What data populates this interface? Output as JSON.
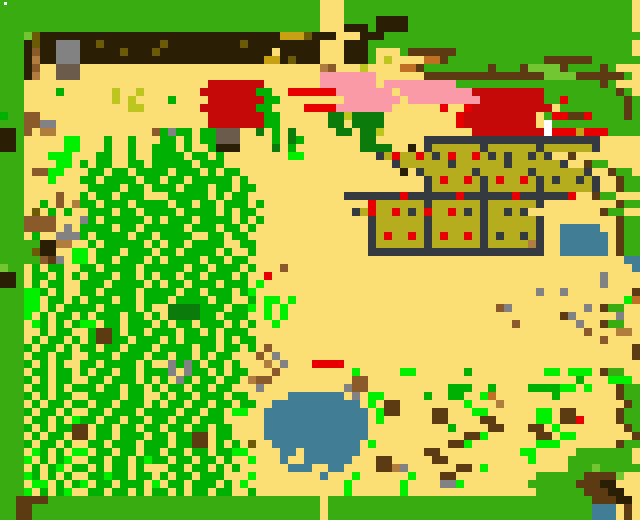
{
  "map": {
    "label": "Top-down pixel-art game world map with sand clearing, western forest, farm plots, buildings and ponds",
    "width_px": 640,
    "height_px": 520,
    "tile_size": 8,
    "palette": {
      ".": "#FBDE74",
      "G": "#38AC11",
      "L": "#72C632",
      "M": "#00B003",
      "g": "#00F000",
      "d": "#0B7B0B",
      "E": "#0A6009",
      "K": "#2A1F04",
      "W": "#5C3A12",
      "B": "#8B5A2B",
      "t": "#B07D3F",
      "y": "#828282",
      "u": "#6B5B4B",
      "r": "#C50808",
      "R": "#E80000",
      "P": "#FA9AA6",
      "O": "#B5AC1E",
      "F": "#343A40",
      "D": "#343A40",
      "A": "#417E96",
      "Y": "#C8A013",
      "v": "#6B5B07",
      "c": "#BCC61F",
      "N": "#C07022",
      "h": "#FFFFFF"
    },
    "legend": {
      ".": "sand",
      "G": "grass border",
      "L": "light green bush",
      "M": "forest green",
      "g": "bright green growth",
      "d": "dark green bush",
      "E": "deep green",
      "K": "dark earth strip",
      "W": "wood wall / tree stump",
      "B": "dirt brown",
      "t": "tan dirt",
      "y": "stone gray",
      "u": "rock base / door",
      "r": "red building",
      "R": "red item",
      "P": "pink flower bed",
      "O": "crate plot fill",
      "F": "crate frame",
      "A": "water",
      "Y": "gold block",
      "v": "dark olive",
      "c": "chartreuse sprout",
      "N": "orange crate",
      "h": "white speck"
    },
    "rows": [
      "GGGGGGGGGGGGGGGGGGGGGGGGGGGGGGGGGGGGGGGG...GGGGGGGGGGGGGGGGGGGGGGGGGGGGGGGGGGGG",
      "GGGGGGGGGGGGGGGGGGGGGGGGGGGGGGGGGGGGGGGG...GGGGGGGGGGGGGGGGGGGGGGGGGGGGGGGGGGGG",
      "GGGGGGGGGGGGGGGGGGGGGGGGGGGGGGGGGGGGGGGG...GGGGKKKKGGGGGGGGGGGGGGGGGGGGGGGGGGGG",
      "GGGGGGGGGGGGGGGGGGGGGGGGGGGGGGGGGGGGGGGG...KKKGKKKKGGGGGGGGGGGGGGGGGGGGGGGGGGGG",
      "GGGLvKKKKKKKKKKKKKKKKKKKKKKKKKKKKKKYYYvKKK...KKKGGGGGGGGGGGGGGGGGGGGGGGGGGGGGGGG",
      "GGGKvKKyyyKKvKKKKKKKvKKKKKKKKKvKKKKKKKKK...KKKGGGGGGGGGGGGGGGGGGGGGGGGGGGGGGGGG",
      "GGGKBKKyyyKKKKKvKKKvKKKKKKKKKKKKKK.KKKKK...KKKG...GWWWWWWGGGGGGGGGGGGGGGGGGGGGG",
      "GGGKtKKyyyKKKKKKKKKKKKKKKKKKKKKKKYYKvKKK...KKKG.c....NNWGGGGGGGGGGGGWWWWWWGGGGGG",
      "GGGKB..uuu..............................tB...c....NNWGGGGGGGGWGGGWLLLLWGGGGWG",
      "GGGKt..uuu..............................PPPPPPP......WWWWWWWWWWWWWWWLLLLWWWWWWG",
      "GGG.......................rrrrrrr.......PPPPPPP.PPPPPPPPPGGGGGGGGGGGGGGGGGGWG",
      "GGG....M......c..c.......rrrrrrrMM..RRRRRRPPPPPPP.PPPPPPPPPrrrrrrrrrGGGGGGGGGWG",
      "GGG...........c.c....M....rrrrrrrMM........PPPPPPP.PPPPPPPPPrrrrrrrrGGRGGGGGGGWG",
      "GGG.............cc.......rrrrrrrMM....RRRRPPPPPPP......R..Rrrrrrrrrrr GGGGGGGGWG",
      "MGGBB.....................rrrrrrrMM......ddcdddd.........Rrrrrrrrrr GRRWWRGGGGWG",
      "GGGBByy...................rrrrrrrMM......dd.dddd.........Rrrrrrrrrr hGGGGGGGGGGG",
      "KKGB.tt............BMyMM.MMuuu..d.M.d.....dd.ddc...........rrrrrrrrrhRRRYRRRGGGG",
      "KKG.....gg...M..M...MM.M.MMuuu....M.dM.......dd......FFFFFFFFFFFFFFFFFFFFFF.....",
      "KKG.....gg...M..M..MMM.M..MKKK....d.M........dddd..K.FOOOOOOFOOOOOOFOOOOOOF.....",
      "GGG...ggg...MM..M..MMMM.MM.M........gg.........FOROOROFOROOROFODOODOF..W..",
      "GGG....gg.M.MM..MM.MMMMM.MMM.....................FOOOOOOFOOOOOOFOOOOOOF..WGG",
      "GGG.BBgg...MM.MM.MMMM.MMM.M.MM....................K.FOOOOOOFOOOOOOFOOOOOOF..WGG",
      "GGG...g...MM.MMMM.MM.MM.MMMMM.M......................FOROOROFOROOROFODOODOF..WGG",
      "GGG........MMMM.MM.MMM.MMM.MM.MM.....................FOOOOOOFOOOOOOFOOOOOOF..WGG",
      "GGG....B..M.MM.MMM...MMMMM.M.MM............FFFFFFFRFFFFFFRFFFFFFRFFFFFFR..WGG",
      "GGG..M.B.tMM.MMM.MMMM.MM.MM.MMM.M.............ROOOOOOFOOOOOOFOOOOOOF.........WGG",
      "GGG.v.M.M..MMM.MM.MMMM.MMMM.M.MM............FOROOROFOROOROFODOODOF.........WGG",
      "GGGBBBB...yM.MMMMM.M.MMM.MMMM.M.M.............FOOOOOOFOOOOOOFOOOOOOF.........WGG",
      "GGGBBBB.y.MMMM.MM.MMMMM.MMM.MM.M..............FOOOOOOFOOOOOOFOOOOOOF..AAAAA..WGG",
      "GGG.M..yyyM.MMMM.MM.MMMM..MM.MM...............FOROOROFOROOROFODOODOF..AAAAAA.WGG",
      "GGGGGKKtt..M.MMMMM.M.MM.MMMM..MM..............FOOOOOOFOOOOOOFOOOOOtF..AAAAAA.WGG",
      "GGGGvKK..gg.MMM.MMM.MM.MMMM.M..M..............FFFFFFFFFFFFFFFFFFFFFF..AAAAAA.WGG",
      "GGGGGBWy.gg.MM.MMM.M.MMMM.MM.MM...............................................AAAAAA.WGG",
      "LGG.M.MM..MM.MMMM.MMMMM.MM.MMM.M...B...........................................A..E..WGG",
      "KKG.MM.M.M.MMM.MM.M.MM.MM.MMM.M..R.........................................y..........WGG",
      "KKG.M.MM..MMM.MMMM.M.MM.MMM.MMM.g..........................................y......g...gWGG",
      "GGGggM.M..MM.MMMM.MMMM.MM.MMM.Mg...................................y..y........WGG",
      "GGGgg.MM.M.MMM.MM.MMM.MMMM.MM..M.gg.g.........................................gN..WGG",
      "GGGgg.M.MMMM.MMMM.M..ddddMMM.MMg.g.g..........................By.........y.WGG",
      "GGGg.M.MM.M.MMM.MM.M.ddddMM.MMM..g.g..................................Wy.....y..WGG",
      "GGG.gM.M.Mgg.MM.MMM.M.MM.MMM.M.M..g.............................B.......y..WGG",
      "GGG..M.MM..MWWM.MM.MMM.MM.M.MMM..........................................B...tt..WGG",
      "GGG.M.MM.M.MWWMM.MMM.M.MMMM.M.MM...........................................B......WGG",
      "GGGM.MM.M.MM.MM.MMM.MMMM.MM.MM.M.B.............................................WGG",
      "GGG.MM.MM..MMM.MMM.MM.MM.M.MM...B.y............................................WGG",
      "GGGM.M.M..MM.MMMM.M..yMyM.MM.M...t.y...RRRR........................................WGG",
      "GGG.MM.MM.M.MM.MM.MMMy.yMM.M.MM...B.........g.....gg......M.........gg.ggg.WGG",
      "GGGM.M.MM..MM.MMM.M.M.yM.MM.MM.tBB..........BB..........................M...ggg.gg.WGG",
      "GGG.MM.M.MMM.MM.MM.M.MM.MM.MM...y..........yBB..........MMM..M....MMMMgg.g...WGG",
      "GGGM.M.MM..MMMM.MM..M.MM.MMM.MM.....AAAAAAA.y.gg.....M..MM..gN.......M.......WGG",
      "GGG.M.MM.MM.MM.MMM.M.MM.MM.MM.MM..AAAAAAAAAAA.g.WW........g...t...............WGG",
      "GGGM.MM.M..MM.MMM.MMMM.MM.MM.gg..AAAAAAAAAAAAA.gWW....WW...gg......gg.WW.....WGG",
      "GGG.MM.M.gMM.MM.MM.MM.MM.MMM.....AAAAAAAAAAAAA.g......WW....WW.....gg.WWR....WGG",
      "GGGM.M.MMWW.MM.MM.MM.MM.MM.MM....AAAAAAAAAAAAA..........M....WW...WW.g........WGG",
      "GGG.M.MM.WW.MM.MMM.MM.MMWW.MM....AAAAAAAAAAAAA............WWg......WW.gg.......WGG",
      "GGGM.MM.M..MM.MMM.MMM.MMWW.M.M.v..AAAAAAAAAAA.g.........WWg........ggg.......WGG",
      "GGG.gM.M.gg.MM.MM.MM.MM.MM.MMgg....AA.AAAAAAA........WW..........gg.....GGGGGGG",
      "GGGg.M.Mg..MM.MM.MgMM.MM.MM.M..g...A..AAAAAA...WW.....WW..........g....GGGGGGGG",
      "GGG.M.Mg.MM.M.MM.M...MM.MM.M.M......AAA..AA....WWty......WW.g..........GGGLGGGGG",
      "GGGgM.M.M..MMgMM.MM.M.MM.MMM...g........A...g......g...WW..........GGGGGGWWWWL",
      "GGG.gg.M.Mg.MM.MMM.g.MM.MMM.M.g............g......g....yyg........GGGGGGWWWKK",
      "GGGg.M.Mg..MM.MM.M.MM.M.MM.MM..M...........g......g................GGGGGGWWWKK",
      "GGWWWWGGGGGGGGGGGGGGGGGGGGGGGGGGGGGGGGGG.GGGGGGGGGGGGGGGGGGGGGGGGGGGGGGGGGWWWKK",
      "GGWWGGGGGGGGGGGGGGGGGGGGGGGGGGGGGGGGGGGG.GGGGGGGGGGGGGGGGGGGGGGGGGGGGGGGGGAAA.W",
      "GGWWGGGGGGGGGGGGGGGGGGGGGGGGGGGGGGGGGGGG.GGGGGGGGGGGGGGGGGGGGGGGGGGGGGGGGGAAA.W"
    ],
    "overlays": [
      {
        "name": "white-speck",
        "x": 4,
        "y": 2,
        "w": 3,
        "h": 3,
        "color": "#FFFFFF"
      }
    ],
    "landmarks": [
      {
        "name": "red-house-north",
        "x": 200,
        "y": 80,
        "w": 56,
        "h": 48,
        "color": "#C50808"
      },
      {
        "name": "red-house-east",
        "x": 472,
        "y": 88,
        "w": 72,
        "h": 48,
        "color": "#C50808"
      },
      {
        "name": "pink-bed-west",
        "x": 336,
        "y": 72,
        "w": 56,
        "h": 32,
        "color": "#FA9AA6"
      },
      {
        "name": "pink-bed-east",
        "x": 400,
        "y": 80,
        "w": 72,
        "h": 24,
        "color": "#FA9AA6"
      },
      {
        "name": "crate-plot-grid-top",
        "x": 424,
        "y": 136,
        "w": 176,
        "h": 60,
        "plots": 3
      },
      {
        "name": "crate-plot-grid-bottom",
        "x": 368,
        "y": 194,
        "w": 176,
        "h": 62,
        "plots": 3
      },
      {
        "name": "pond-east",
        "x": 560,
        "y": 224,
        "w": 48,
        "h": 48,
        "color": "#417E96"
      },
      {
        "name": "pond-center",
        "x": 264,
        "y": 392,
        "w": 108,
        "h": 80,
        "color": "#417E96"
      },
      {
        "name": "walled-garden-northeast",
        "x": 544,
        "y": 56,
        "w": 48,
        "h": 24
      },
      {
        "name": "rock-north",
        "x": 56,
        "y": 40,
        "w": 24,
        "h": 24,
        "color": "#828282"
      },
      {
        "name": "forest-west",
        "x": 16,
        "y": 104,
        "w": 240,
        "h": 392
      },
      {
        "name": "debris-field-east",
        "x": 520,
        "y": 288,
        "w": 96,
        "h": 56
      },
      {
        "name": "hut-southeast",
        "x": 600,
        "y": 472,
        "w": 36,
        "h": 32
      }
    ]
  }
}
